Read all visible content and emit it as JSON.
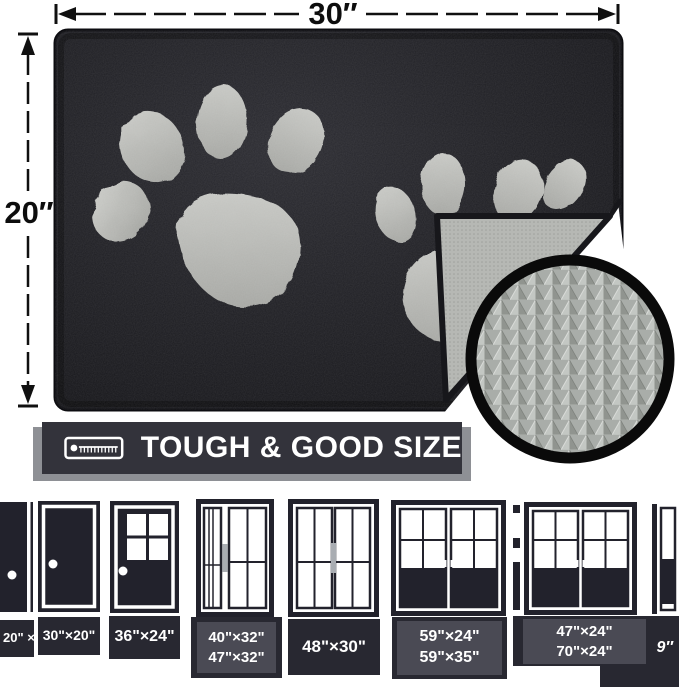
{
  "dimensions": {
    "width": "30″",
    "height": "20″"
  },
  "banner": {
    "label": "TOUGH & GOOD SIZE",
    "icon": "tape-measure-icon",
    "background": "#33333b",
    "shadow_color": "#8e9095"
  },
  "mat": {
    "surface_color": "#1f1f24",
    "paw_print_color": "#b5b6b2",
    "backing_color": "#b6b8b4",
    "inset_ring_color": "#0a0a0a",
    "inset_texture_color": "#a9ada9"
  },
  "doors": [
    {
      "type": "solid-door-partial-left",
      "line1": "20\" ×",
      "line2": ""
    },
    {
      "type": "solid-door",
      "line1": "30\"×20\"",
      "line2": ""
    },
    {
      "type": "half-glass-door",
      "line1": "36\"×24\"",
      "line2": ""
    },
    {
      "type": "sliding-door-sidelite",
      "line1": "40\"×32\"",
      "line2": "47\"×32\""
    },
    {
      "type": "sliding-door",
      "line1": "48\"×30\"",
      "line2": ""
    },
    {
      "type": "french-double-door",
      "line1": "59\"×24\"",
      "line2": "59\"×35\""
    },
    {
      "type": "french-double-door",
      "line1": "47\"×24\"",
      "line2": "70\"×24\""
    },
    {
      "type": "door-partial-right",
      "line1": "9″",
      "line2": ""
    }
  ]
}
